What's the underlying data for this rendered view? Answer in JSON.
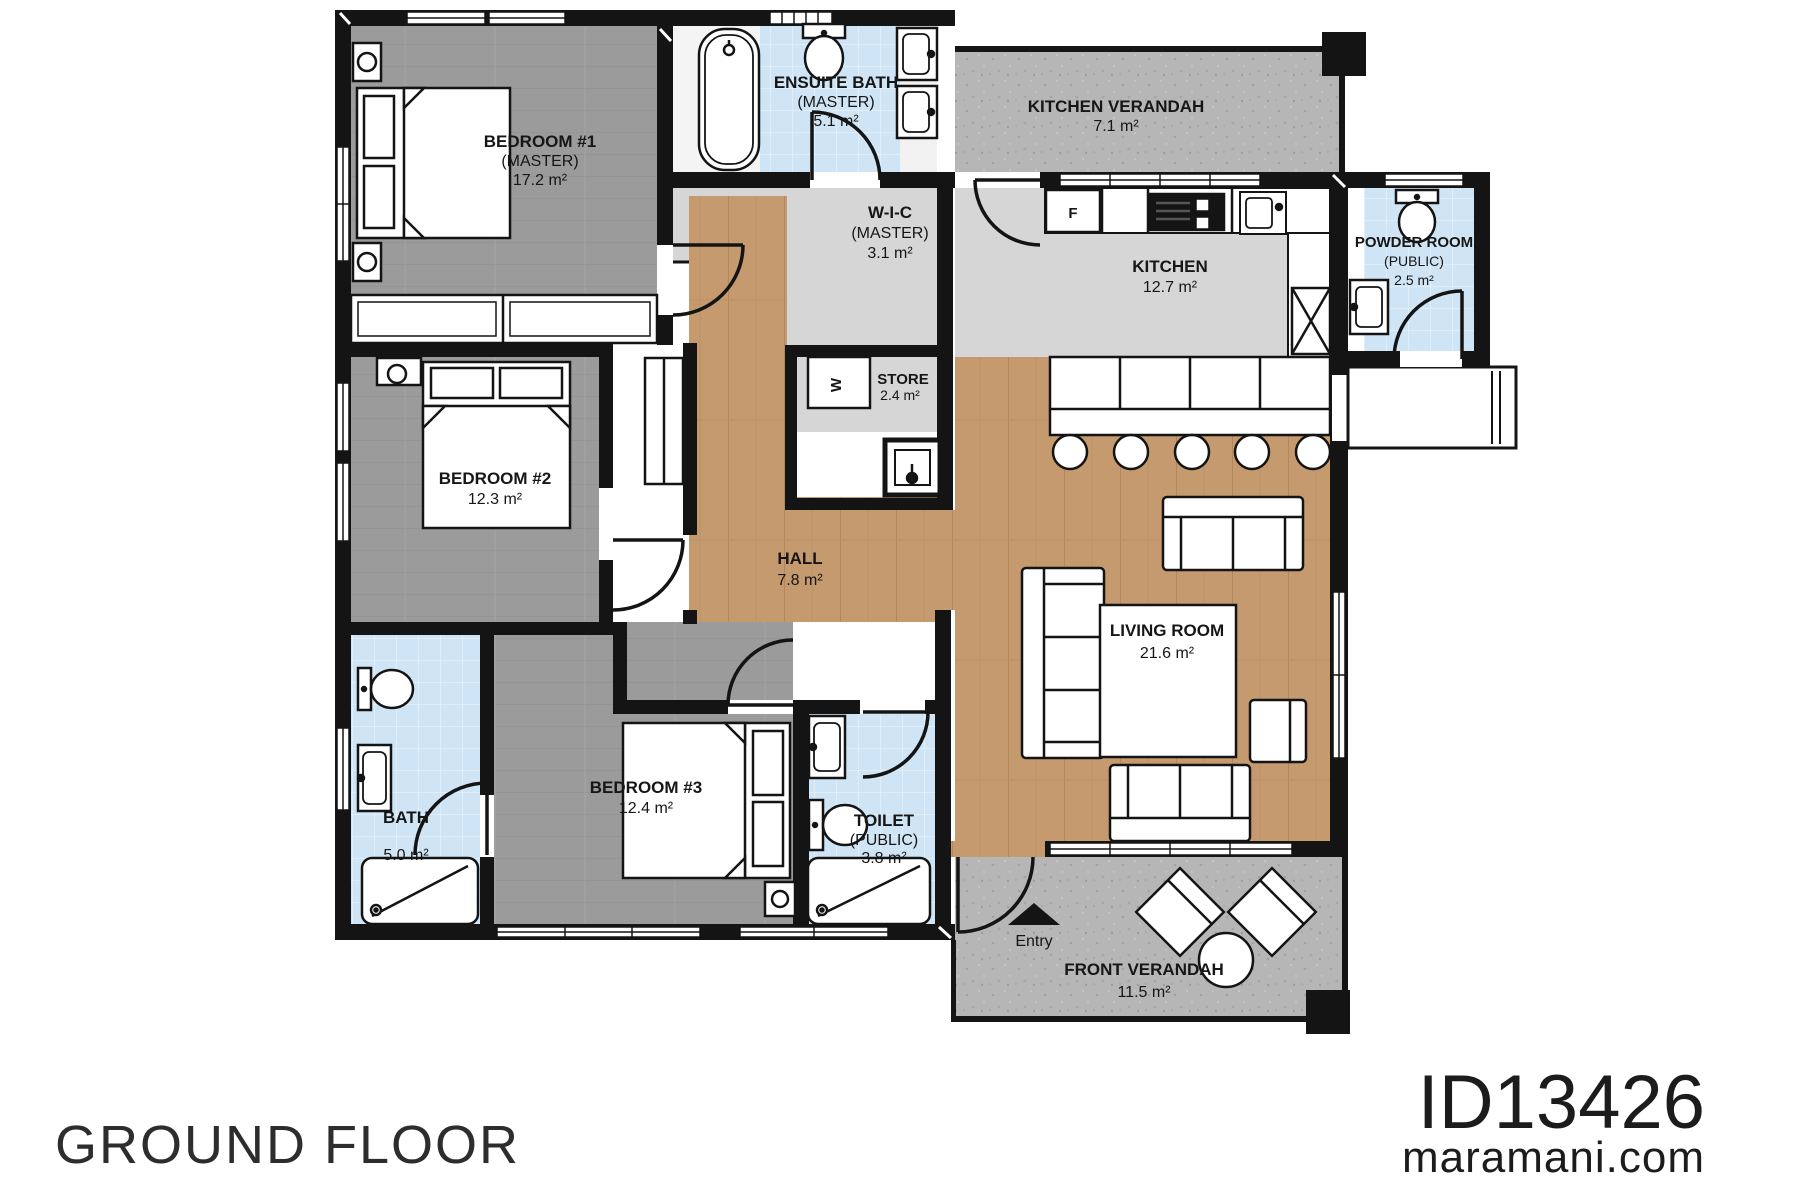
{
  "title_block": {
    "floor_label": "GROUND FLOOR",
    "plan_id": "ID13426",
    "website": "maramani.com"
  },
  "rooms": {
    "bedroom1": {
      "name": "BEDROOM #1",
      "sub": "(MASTER)",
      "area": "17.2 m²"
    },
    "ensuite": {
      "name": "ENSUITE BATH",
      "sub": "(MASTER)",
      "area": "5.1 m²"
    },
    "wic": {
      "name": "W-I-C",
      "sub": "(MASTER)",
      "area": "3.1 m²"
    },
    "kitchen_verandah": {
      "name": "KITCHEN VERANDAH",
      "area": "7.1 m²"
    },
    "kitchen": {
      "name": "KITCHEN",
      "area": "12.7 m²"
    },
    "powder": {
      "name": "POWDER ROOM",
      "sub": "(PUBLIC)",
      "area": "2.5 m²"
    },
    "bedroom2": {
      "name": "BEDROOM #2",
      "area": "12.3 m²"
    },
    "store": {
      "name": "STORE",
      "area": "2.4 m²"
    },
    "hall": {
      "name": "HALL",
      "area": "7.8 m²"
    },
    "living": {
      "name": "LIVING ROOM",
      "area": "21.6 m²"
    },
    "bath": {
      "name": "BATH",
      "area": "5.0 m²"
    },
    "bedroom3": {
      "name": "BEDROOM #3",
      "area": "12.4 m²"
    },
    "toilet": {
      "name": "TOILET",
      "sub": "(PUBLIC)",
      "area": "3.8 m²"
    },
    "front_verandah": {
      "name": "FRONT VERANDAH",
      "area": "11.5 m²"
    }
  },
  "annotations": {
    "entry_label": "Entry",
    "fridge_label": "F",
    "washer_label": "W"
  },
  "colors": {
    "wall": "#141414",
    "bedroom_floor": "#9b9b9b",
    "tile_floor": "#cfe4f5",
    "utility_floor": "#d6d6d6",
    "wood_floor": "#c49a6e",
    "concrete_floor": "#b5b5b5",
    "fixture_stroke": "#141414"
  }
}
